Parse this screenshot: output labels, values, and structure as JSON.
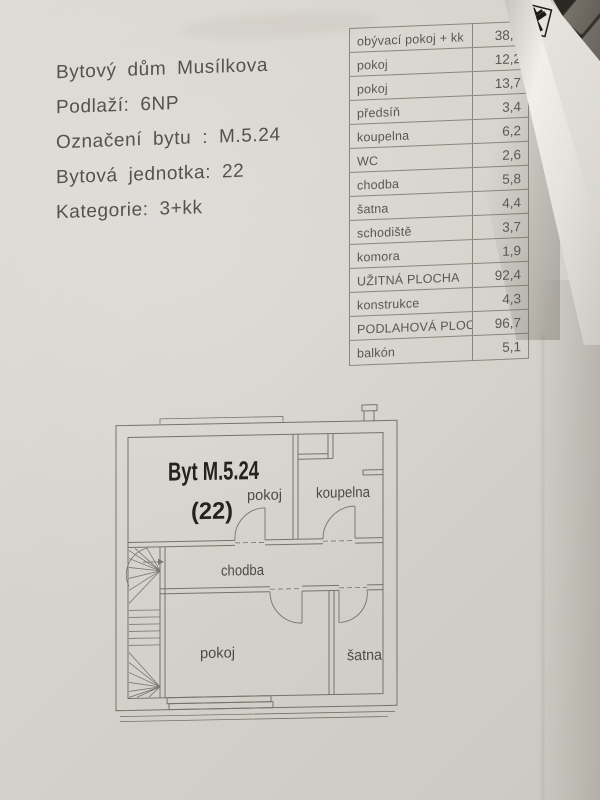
{
  "photo": {
    "header": {
      "lines": [
        "Bytový dům Musílkova",
        "Podlaží: 6NP",
        "Označení bytu : M.5.24",
        "Bytová jednotka: 22",
        "Kategorie: 3+kk"
      ]
    },
    "area_table": {
      "rows": [
        {
          "label": "obývací pokoj + kk",
          "value": "38,5"
        },
        {
          "label": "pokoj",
          "value": "12,2"
        },
        {
          "label": "pokoj",
          "value": "13,7"
        },
        {
          "label": "předsíň",
          "value": "3,4"
        },
        {
          "label": "koupelna",
          "value": "6,2"
        },
        {
          "label": "WC",
          "value": "2,6"
        },
        {
          "label": "chodba",
          "value": "5,8"
        },
        {
          "label": "šatna",
          "value": "4,4"
        },
        {
          "label": "schodiště",
          "value": "3,7"
        },
        {
          "label": "komora",
          "value": "1,9"
        },
        {
          "label": "UŽITNÁ PLOCHA",
          "value": "92,4"
        },
        {
          "label": "konstrukce",
          "value": "4,3"
        },
        {
          "label": "PODLAHOVÁ PLOCHA",
          "value": "96,7"
        },
        {
          "label": "balkón",
          "value": "5,1"
        }
      ]
    },
    "floor_plan": {
      "title": "Byt M.5.24",
      "unit_number": "(22)",
      "rooms": {
        "room_top": "pokoj",
        "bathroom": "koupelna",
        "hallway": "chodba",
        "room_bottom": "pokoj",
        "closet": "šatna"
      }
    },
    "corner": {
      "logo_icon": "raiffeisen-emblem-icon",
      "partial_letter": "R"
    },
    "colors": {
      "paper": "#d6d3cd",
      "ink": "#56524b",
      "table_line": "#8b867d",
      "plan_line": "#76726b",
      "logo_black": "#1c1a15"
    }
  }
}
